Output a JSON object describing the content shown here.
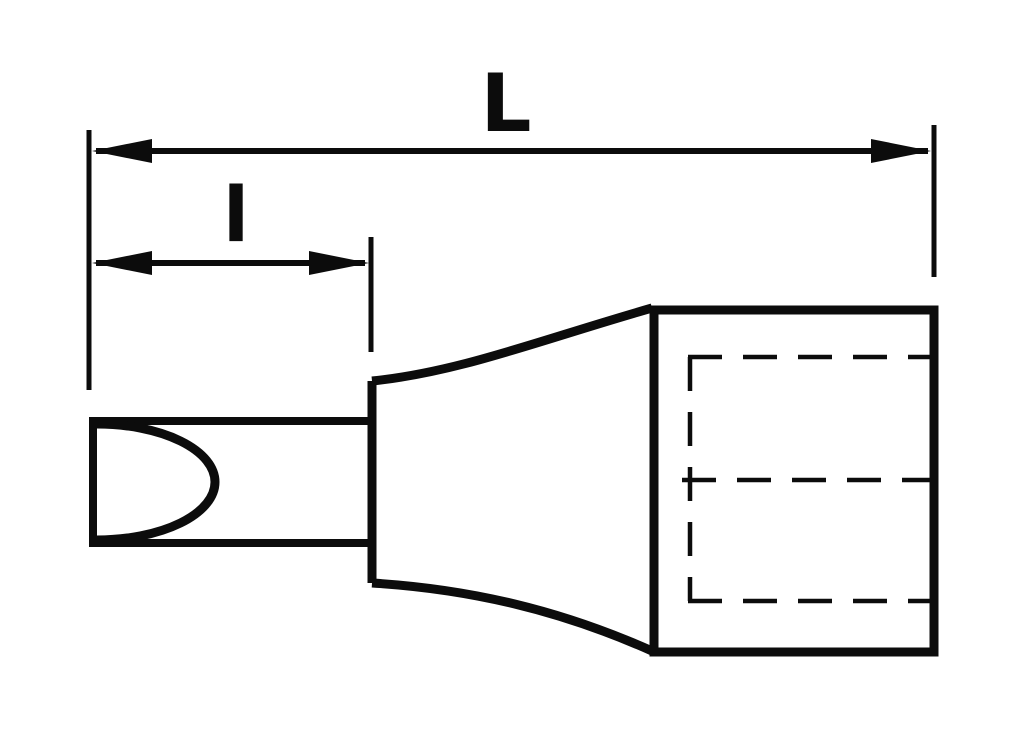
{
  "page": {
    "background": "#ffffff"
  },
  "drawing": {
    "kind": "technical line drawing (scanned catalog style)",
    "subject": "socket bit with slotted flat-blade tip and square-drive socket, side view",
    "ink_color": "#0c0c0c",
    "dimension_labels": {
      "overall_length": "L",
      "bit_length": "l"
    },
    "parts": [
      {
        "name": "slotted-bit-tip"
      },
      {
        "name": "bit-shank"
      },
      {
        "name": "tapered-neck"
      },
      {
        "name": "socket-body"
      },
      {
        "name": "hidden-square-drive"
      }
    ]
  }
}
